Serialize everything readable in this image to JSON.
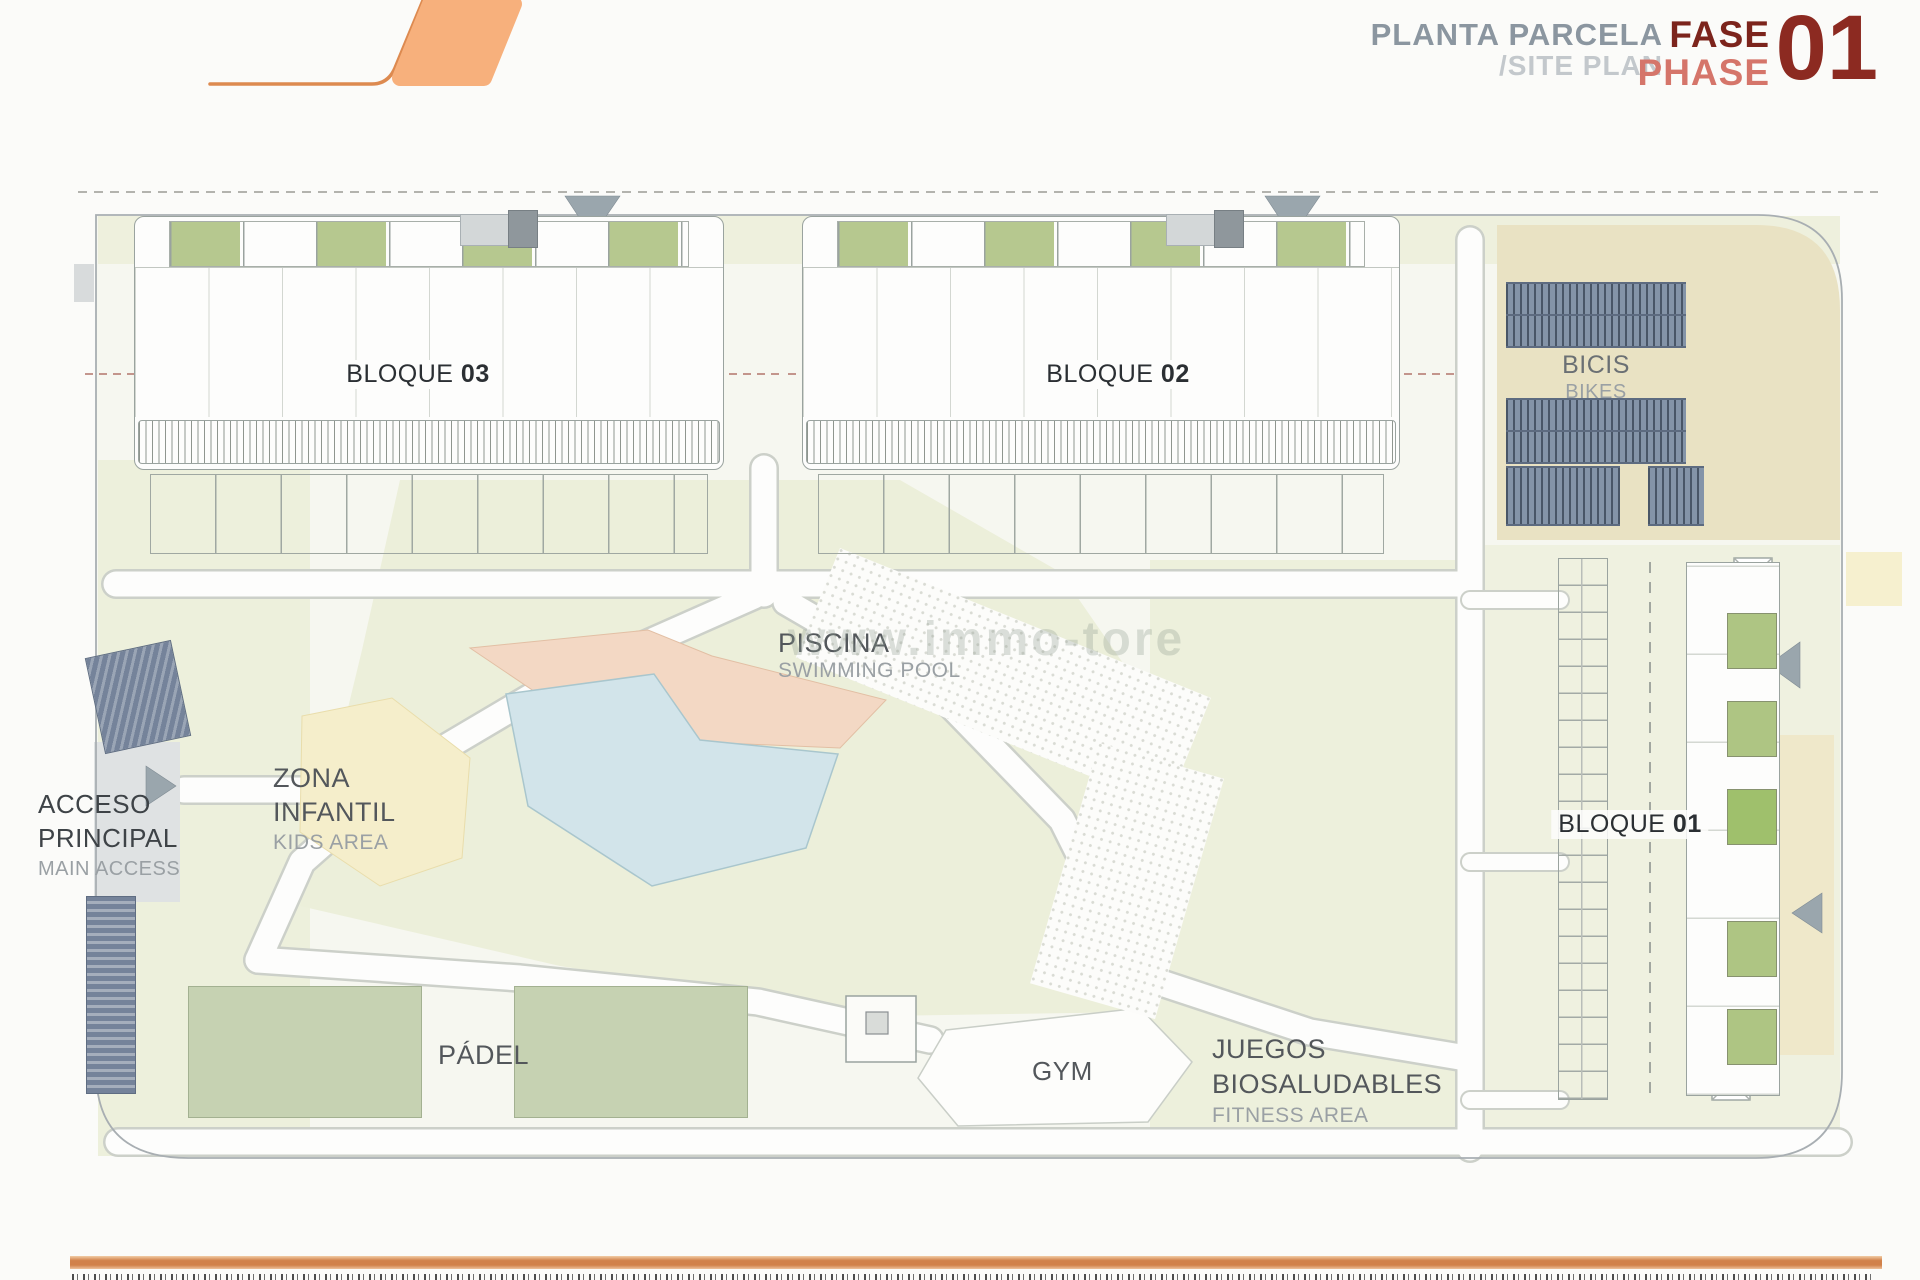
{
  "header": {
    "plan_title": "PLANTA PARCELA",
    "plan_subtitle": "/SITE PLAN",
    "phase": {
      "es": "FASE",
      "en": "PHASE",
      "number": "01"
    },
    "colors": {
      "title_gray": "#8b96a0",
      "subtitle_gray": "#c3c8cc",
      "phase_dark_red": "#7c241c",
      "phase_salmon": "#d5756a",
      "number_red": "#8c2a21",
      "logo_fill": "#f7b07c",
      "logo_stroke": "#dd8a50"
    }
  },
  "plan": {
    "watermark": "www.immo-tore",
    "blocks": {
      "b03": {
        "name": "BLOQUE",
        "num": "03"
      },
      "b02": {
        "name": "BLOQUE",
        "num": "02"
      },
      "b01": {
        "name": "BLOQUE",
        "num": "01"
      }
    },
    "labels": {
      "bicis": {
        "es": "BICIS",
        "en": "BIKES"
      },
      "piscina": {
        "es": "PISCINA",
        "en": "SWIMMING POOL"
      },
      "zona_infantil": {
        "line1": "ZONA",
        "line2": "INFANTIL",
        "en": "KIDS AREA"
      },
      "acceso": {
        "line1": "ACCESO",
        "line2": "PRINCIPAL",
        "en": "MAIN ACCESS"
      },
      "padel": {
        "es": "PÁDEL"
      },
      "gym": {
        "es": "GYM"
      },
      "juegos": {
        "line1": "JUEGOS",
        "line2": "BIOSALUDABLES",
        "en": "FITNESS AREA"
      }
    },
    "area_colors": {
      "lawn": "#ecefda",
      "pool_water": "#d2e4ea",
      "pool_deck": "#f3d8c4",
      "kids_area": "#f5eecb",
      "terrace_green": "#b6c88f",
      "bike_rack": "#8494a8",
      "boundary": "#a8aeb2"
    }
  }
}
